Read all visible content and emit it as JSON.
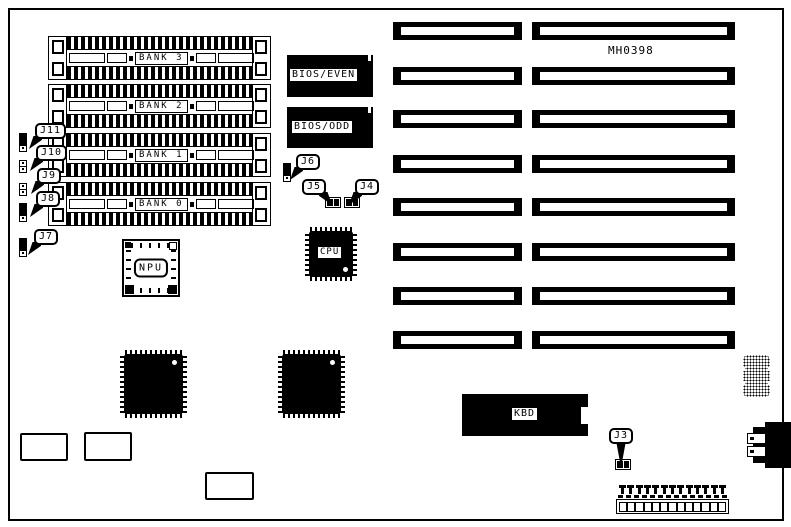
{
  "board": {
    "part_number": "MH0398",
    "colors": {
      "ink": "#000000",
      "background": "#ffffff"
    }
  },
  "memory_banks": [
    {
      "label": "BANK 3"
    },
    {
      "label": "BANK 2"
    },
    {
      "label": "BANK 1"
    },
    {
      "label": "BANK 0"
    }
  ],
  "bios_chips": [
    {
      "label": "BIOS/EVEN"
    },
    {
      "label": "BIOS/ODD"
    }
  ],
  "chips": {
    "npu_label": "NPU",
    "cpu_label": "CPU",
    "kbd_label": "KBD"
  },
  "jumpers": [
    {
      "id": "J11"
    },
    {
      "id": "J10"
    },
    {
      "id": "J9"
    },
    {
      "id": "J8"
    },
    {
      "id": "J7"
    },
    {
      "id": "J6"
    },
    {
      "id": "J5"
    },
    {
      "id": "J4"
    },
    {
      "id": "J3"
    }
  ],
  "expansion_slots": {
    "count": 8
  }
}
